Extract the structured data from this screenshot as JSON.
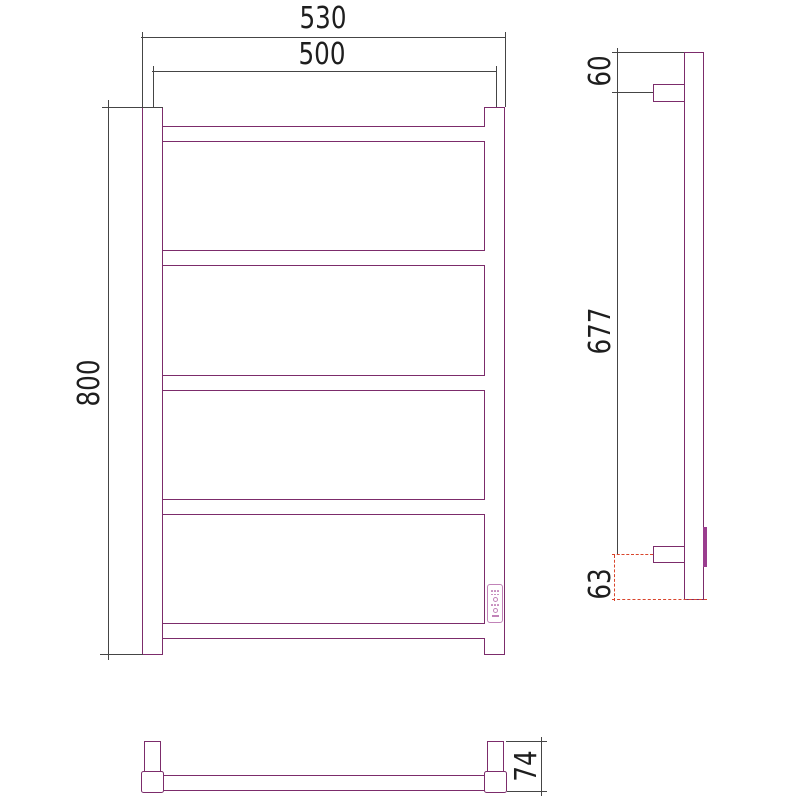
{
  "drawing_type": "technical-dimension-drawing",
  "subject": "ladder towel rail, 5 crossbars, wall brackets, side control panel",
  "colors": {
    "object": "#7c2c6b",
    "object_light": "#c183b8",
    "object_light2": "#9a3d8e",
    "dimension_line": "#454545",
    "text": "#1e1e1e",
    "highlight_red": "#d9452c",
    "background": "#ffffff"
  },
  "front_view": {
    "rung_count": 5
  },
  "dims": {
    "front_overall_width": "530",
    "front_rail_center_width": "500",
    "front_height": "800",
    "side_top_bracket_offset": "60",
    "side_bracket_spacing": "677",
    "side_bottom_offset": "63",
    "bottom_depth": "74"
  }
}
